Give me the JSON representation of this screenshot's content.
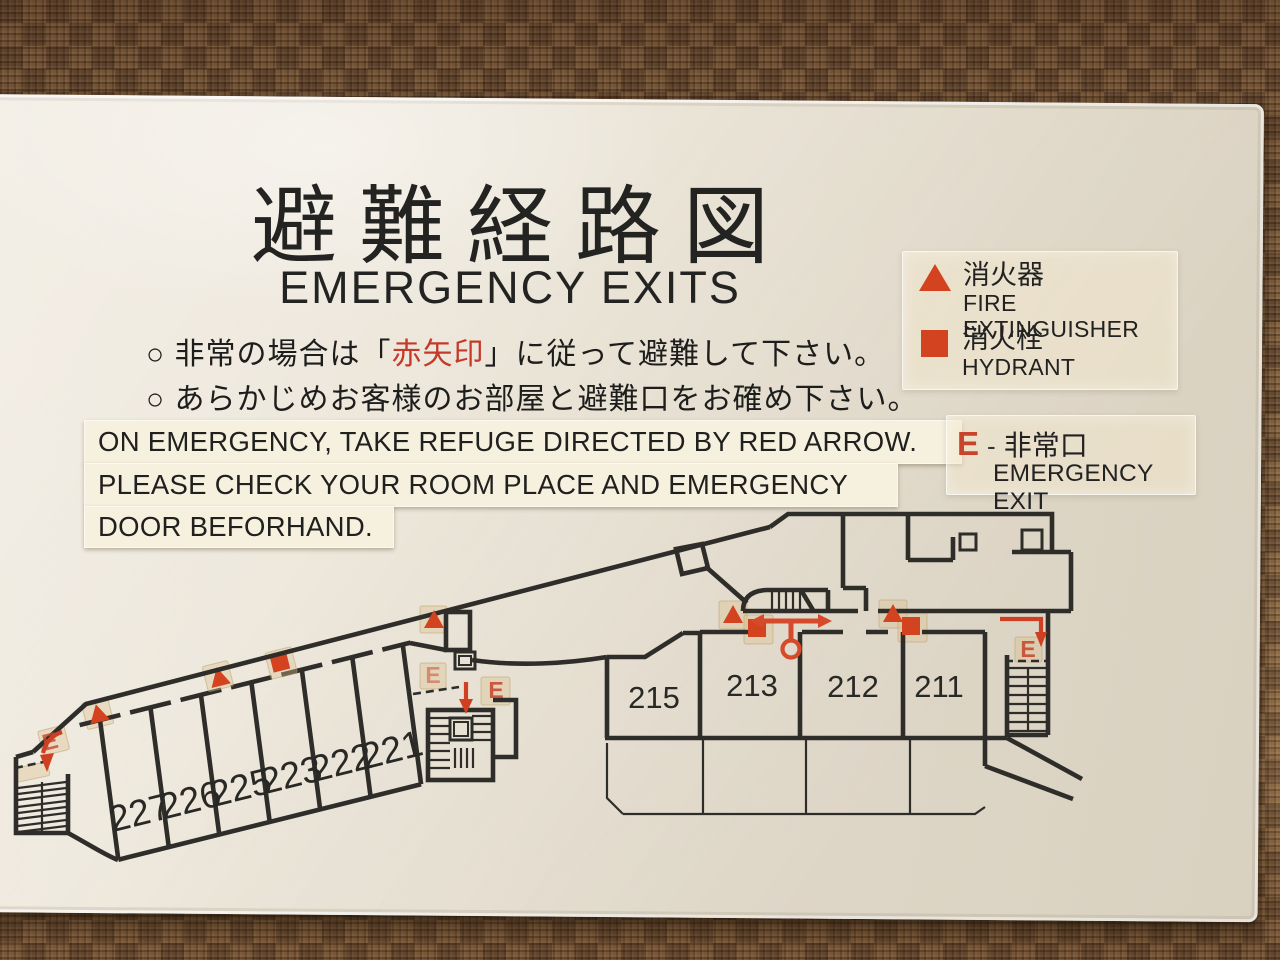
{
  "sign": {
    "title_jp": "避難経路図",
    "title_en": "EMERGENCY EXITS",
    "note1": {
      "bullet": "○",
      "before": "非常の場合は「",
      "red": "赤矢印",
      "after": "」に従って避難して下さい。"
    },
    "note2": {
      "bullet": "○",
      "text": "あらかじめお客様のお部屋と避難口をお確め下さい。"
    },
    "english_notes": {
      "line1": "ON EMERGENCY, TAKE REFUGE DIRECTED BY RED ARROW.",
      "line2": "PLEASE CHECK YOUR ROOM PLACE AND EMERGENCY",
      "line3": "DOOR BEFORHAND."
    },
    "legend_fire": {
      "jp": "消火器",
      "en": "FIRE EXTINGUISHER"
    },
    "legend_hydrant": {
      "jp": "消火栓",
      "en": "HYDRANT"
    },
    "legend_exit": {
      "symbol": "E",
      "dash": "-",
      "jp": "非常口",
      "en": "EMERGENCY EXIT"
    },
    "colors": {
      "accent_red": "#cf3f22",
      "wall_line": "#2e2d2a",
      "board": "#ebe5d8",
      "sticker": "#d9bf8d"
    },
    "floorplan": {
      "left_rooms": [
        "227",
        "226",
        "225",
        "223",
        "222",
        "221"
      ],
      "right_rooms": [
        "215",
        "213",
        "212",
        "211"
      ]
    }
  }
}
